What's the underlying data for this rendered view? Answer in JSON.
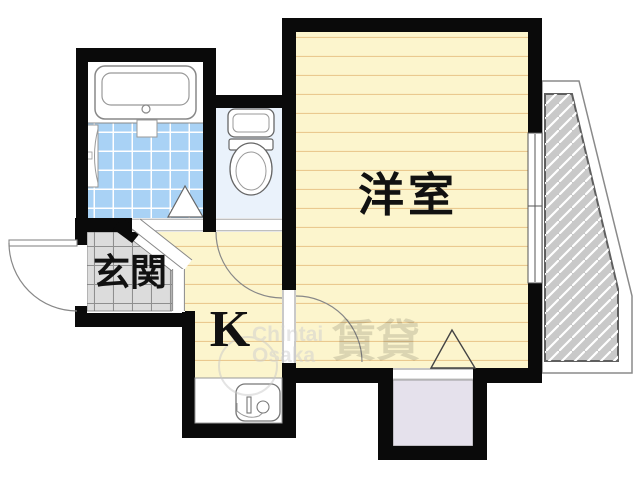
{
  "plan": {
    "type": "apartment-floorplan"
  },
  "rooms": {
    "western_room": {
      "label": "洋室"
    },
    "kitchen": {
      "label": "K"
    },
    "entrance": {
      "label": "玄関"
    }
  },
  "fixtures": {
    "bathtub": "bathtub-icon",
    "toilet": "toilet-icon",
    "kitchen_sink": "kitchen-sink-icon",
    "closet": "closet",
    "balcony": "balcony",
    "window": "sliding-window",
    "entrance_door": "swing-door",
    "toilet_door": "swing-door",
    "room_door": "swing-door",
    "bath_door": "folding-door-triangle",
    "closet_door": "folding-door-triangle"
  },
  "watermark": {
    "brand_line1": "Chintai",
    "brand_line2": "Osaka",
    "stamp": "賃貸"
  },
  "colors": {
    "wall_black": "#0a0a0a",
    "room_yellow": "#fcf5cd",
    "floor_line": "#eac98f",
    "tile_blue": "#a9d2f5",
    "toilet_blue": "#eaf2fb",
    "genkan_gray": "#dcdcdc",
    "closet_lavender": "#e5e1ec",
    "balcony_gray": "#c9c9c9",
    "fixture_outline": "#777777"
  }
}
